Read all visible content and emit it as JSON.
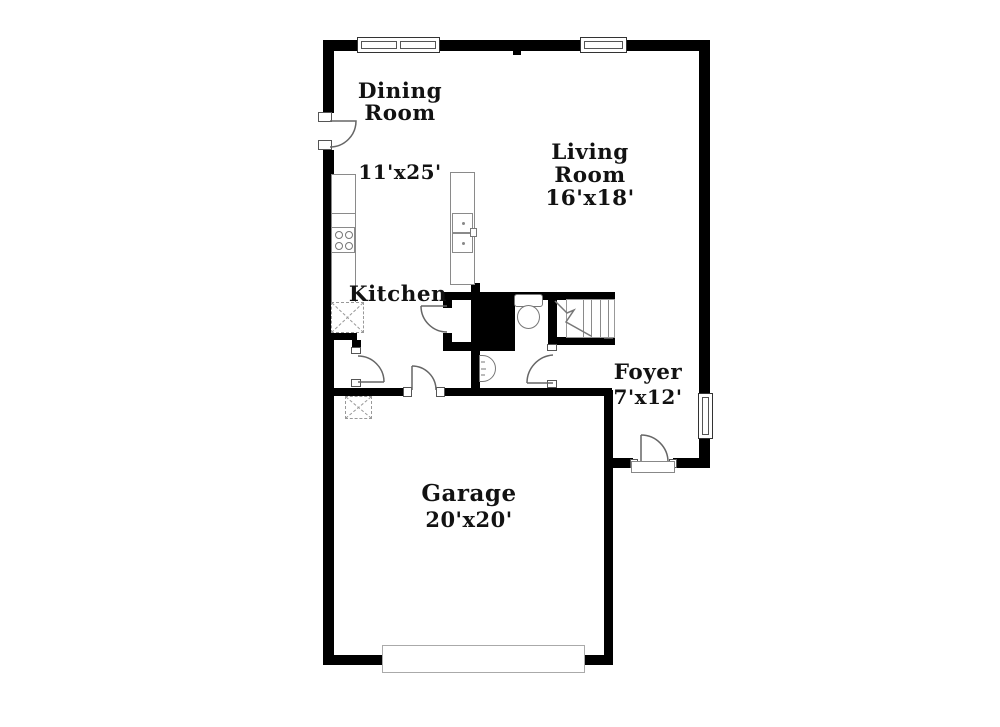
{
  "document_title": "First floor plan",
  "rooms": {
    "dining": {
      "name_line1": "Dining",
      "name_line2": "Room",
      "dims": "11'x25'"
    },
    "living": {
      "name_line1": "Living",
      "name_line2": "Room",
      "dims": "16'x18'"
    },
    "kitchen": {
      "name": "Kitchen"
    },
    "foyer": {
      "name": "Foyer",
      "dims": "7'x12'"
    },
    "garage": {
      "name": "Garage",
      "dims": "20'x20'"
    }
  },
  "fixtures": [
    "stove-icon",
    "kitchen-sink-icon",
    "toilet-icon",
    "powder-sink-icon",
    "stairs-icon",
    "garage-door-icon",
    "window-icon",
    "door-swing-icon",
    "pantry-icon",
    "closet-icon"
  ],
  "colors": {
    "wall": "#000000",
    "fixture_line": "#8a8a8a",
    "text": "#121212",
    "background": "#ffffff"
  }
}
